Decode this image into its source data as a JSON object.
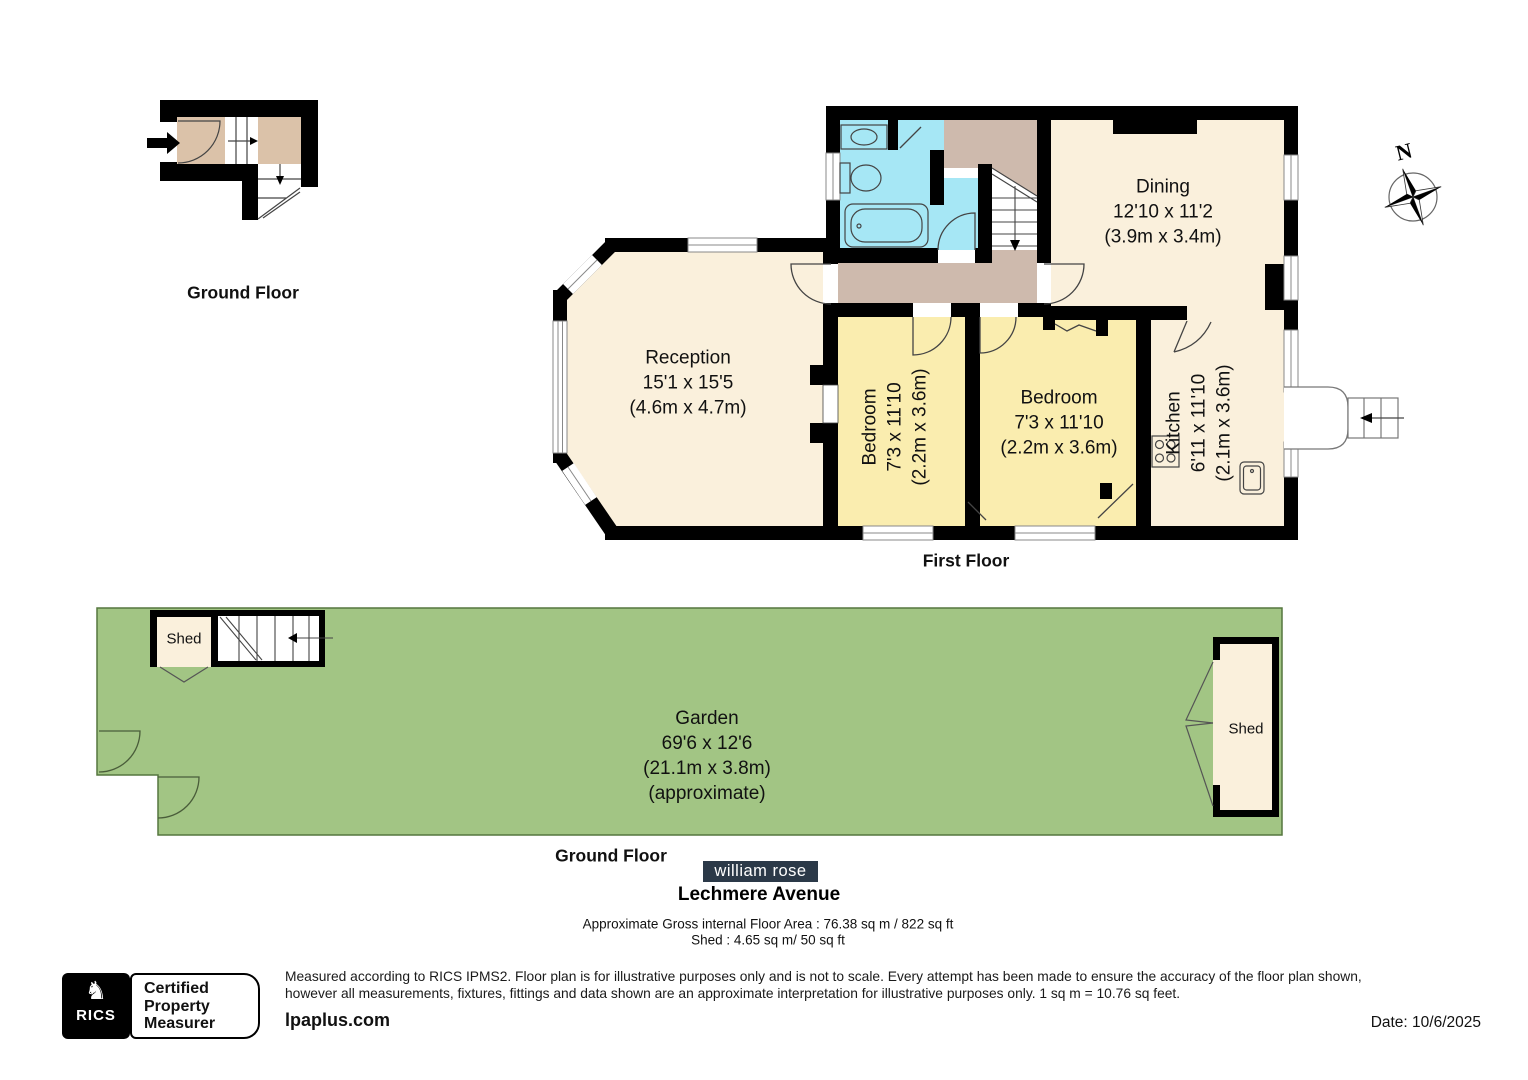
{
  "title": {
    "property": "Lechmere Avenue",
    "brand": "william rose"
  },
  "floor_labels": {
    "ground_floor_top": "Ground Floor",
    "first_floor": "First Floor",
    "ground_floor_garden": "Ground Floor"
  },
  "compass": {
    "north": "N"
  },
  "rooms": {
    "dining": {
      "name": "Dining",
      "imperial": "12'10 x 11'2",
      "metric": "(3.9m x 3.4m)"
    },
    "reception": {
      "name": "Reception",
      "imperial": "15'1 x 15'5",
      "metric": "(4.6m x 4.7m)"
    },
    "bedroom_left": {
      "name": "Bedroom",
      "imperial": "7'3 x 11'10",
      "metric": "(2.2m x 3.6m)"
    },
    "bedroom_middle": {
      "name": "Bedroom",
      "imperial": "7'3 x 11'10",
      "metric": "(2.2m x 3.6m)"
    },
    "kitchen": {
      "name": "Kitchen",
      "imperial": "6'11 x 11'10",
      "metric": "(2.1m x 3.6m)"
    },
    "garden": {
      "name": "Garden",
      "imperial": "69'6 x 12'6",
      "metric": "(21.1m x 3.8m)",
      "note": "(approximate)"
    },
    "shed_garden_left": {
      "name": "Shed"
    },
    "shed_garden_right": {
      "name": "Shed"
    }
  },
  "areas": {
    "gross_internal": "Approximate Gross internal Floor Area : 76.38 sq m / 822 sq ft",
    "shed": "Shed : 4.65 sq m/ 50 sq ft"
  },
  "footer": {
    "disclaimer_lines": [
      "Measured according to RICS IPMS2. Floor plan is for illustrative purposes only and is not to scale. Every attempt has been made to ensure the accuracy of the floor plan shown,",
      "however all measurements, fixtures, fittings and data shown are an approximate interpretation for illustrative purposes only. 1 sq m = 10.76 sq feet."
    ],
    "website": "lpaplus.com",
    "date": "Date: 10/6/2025",
    "rics": {
      "label": "RICS",
      "cert_lines": [
        "Certified",
        "Property",
        "Measurer"
      ]
    }
  },
  "colors": {
    "room_cream": "#FAF0DC",
    "bedroom_yellow": "#FAEDAF",
    "bathroom_cyan": "#A6E7F5",
    "hall_tan": "#CEBAAD",
    "entry_tan": "#DBC2A9",
    "garden_green": "#A2C584",
    "wall_black": "#000000",
    "brand_navy": "#2B3948"
  }
}
